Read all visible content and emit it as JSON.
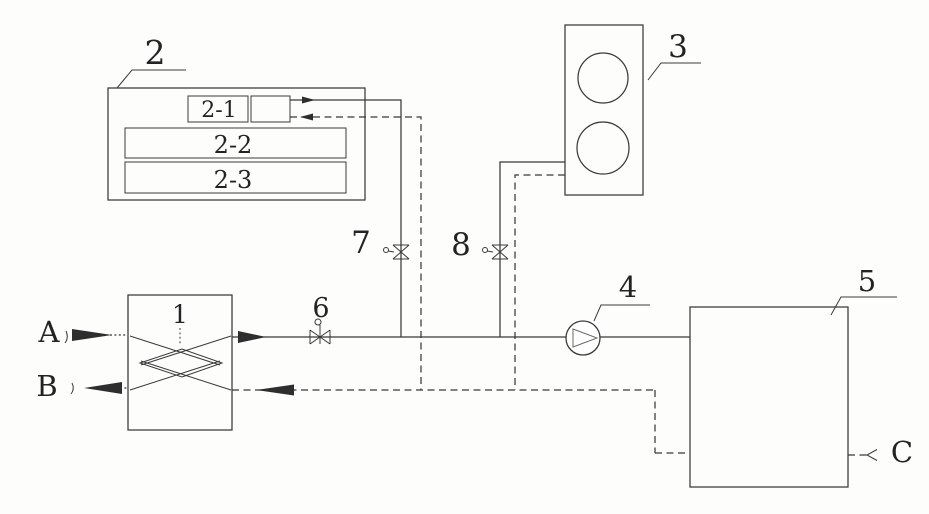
{
  "colors": {
    "background": "#fdfdfc",
    "line": "#3a3a3a",
    "text": "#232323"
  },
  "labels": {
    "n1": "1",
    "n2": "2",
    "n2_1": "2-1",
    "n2_2": "2-2",
    "n2_3": "2-3",
    "n3": "3",
    "n4": "4",
    "n5": "5",
    "n6": "6",
    "n7": "7",
    "n8": "8",
    "a": "A",
    "b": "B",
    "c": "C"
  },
  "symbols": {
    "valve": "bowtie-valve-icon",
    "pump": "circle-impeller-pump-icon",
    "flow_arrow": "filled-flow-arrow-icon",
    "heat_exchanger_core": "crossed-flow-diamond-icon",
    "fan": "fan-circle-icon"
  }
}
